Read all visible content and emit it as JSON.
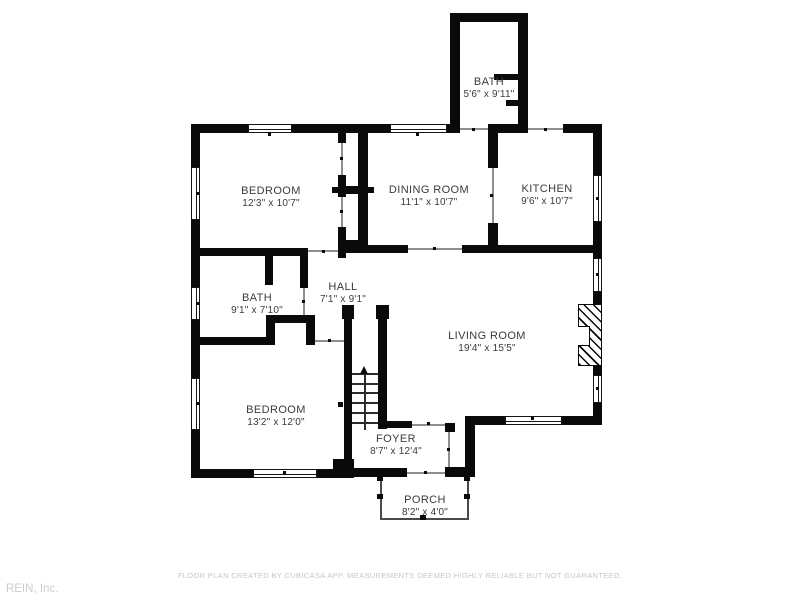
{
  "page": {
    "footer_disclaimer": "FLOOR PLAN CREATED BY CUBICASA APP. MEASUREMENTS DEEMED HIGHLY RELIABLE BUT NOT GUARANTEED.",
    "attribution": "REIN, Inc."
  },
  "rooms": [
    {
      "id": "bath-upper",
      "name": "BATH",
      "dims": "5'6\" x 9'11\""
    },
    {
      "id": "bedroom-upper",
      "name": "BEDROOM",
      "dims": "12'3\" x 10'7\""
    },
    {
      "id": "dining-room",
      "name": "DINING ROOM",
      "dims": "11'1\" x 10'7\""
    },
    {
      "id": "kitchen",
      "name": "KITCHEN",
      "dims": "9'6\" x 10'7\""
    },
    {
      "id": "bath-main",
      "name": "BATH",
      "dims": "9'1\" x 7'10\""
    },
    {
      "id": "hall",
      "name": "HALL",
      "dims": "7'1\" x 9'1\""
    },
    {
      "id": "living-room",
      "name": "LIVING ROOM",
      "dims": "19'4\" x 15'5\""
    },
    {
      "id": "bedroom-lower",
      "name": "BEDROOM",
      "dims": "13'2\" x 12'0\""
    },
    {
      "id": "foyer",
      "name": "FOYER",
      "dims": "8'7\" x 12'4\""
    },
    {
      "id": "porch",
      "name": "PORCH",
      "dims": "8'2\" x 4'0\""
    }
  ],
  "colors": {
    "wall": "#0a0a0a",
    "label_text": "#3b3b3b",
    "muted_text": "#c7c7c7"
  }
}
